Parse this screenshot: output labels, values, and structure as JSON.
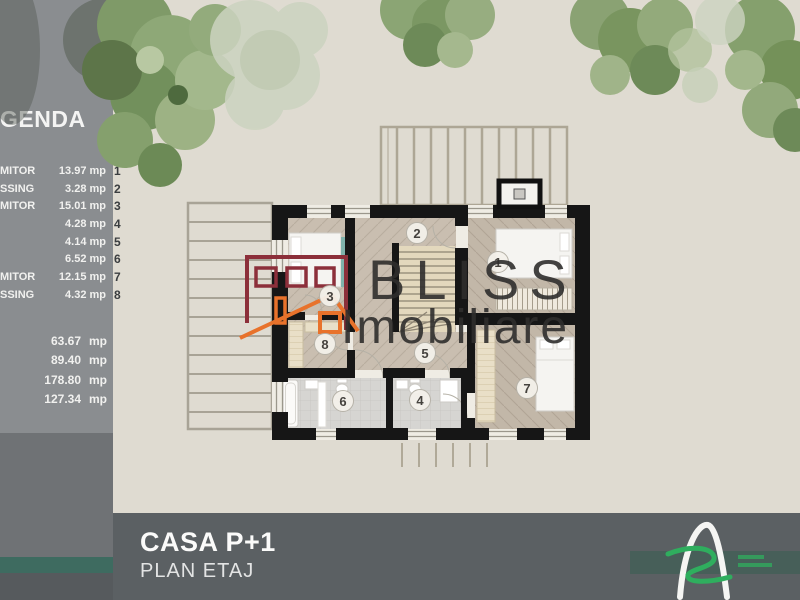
{
  "legend": {
    "title": "GENDA",
    "rows": [
      {
        "label": "MITOR",
        "value": "13.97 mp",
        "index": "1"
      },
      {
        "label": "SSING",
        "value": "3.28 mp",
        "index": "2"
      },
      {
        "label": "MITOR",
        "value": "15.01 mp",
        "index": "3"
      },
      {
        "label": "",
        "value": "4.28 mp",
        "index": "4"
      },
      {
        "label": "",
        "value": "4.14 mp",
        "index": "5"
      },
      {
        "label": "",
        "value": "6.52 mp",
        "index": "6"
      },
      {
        "label": "MITOR",
        "value": "12.15 mp",
        "index": "7"
      },
      {
        "label": "SSING",
        "value": "4.32 mp",
        "index": "8"
      }
    ],
    "totals": [
      {
        "value": "63.67",
        "unit": "mp"
      },
      {
        "value": "89.40",
        "unit": "mp"
      },
      {
        "value": "178.80",
        "unit": "mp"
      },
      {
        "value": "127.34",
        "unit": "mp"
      }
    ]
  },
  "plan": {
    "badges": [
      "1",
      "2",
      "3",
      "4",
      "5",
      "6",
      "7",
      "8"
    ]
  },
  "watermark": {
    "line1": "BLISS",
    "line2": "Imobiliare"
  },
  "footer": {
    "title": "CASA P+1",
    "subtitle": "PLAN ETAJ"
  },
  "colors": {
    "background": "#DFDBD1",
    "sidebar": "#8A8D90",
    "sidebar_lower": "#6F7275",
    "teal_stripe": "#3E6B60",
    "footer_bar": "#5B6063",
    "walls": "#161616",
    "logo_maroon": "#8C2F3A",
    "logo_orange": "#E8722B",
    "logo_green": "#2FAE5E",
    "watermark_text": "#2F2E2D"
  }
}
